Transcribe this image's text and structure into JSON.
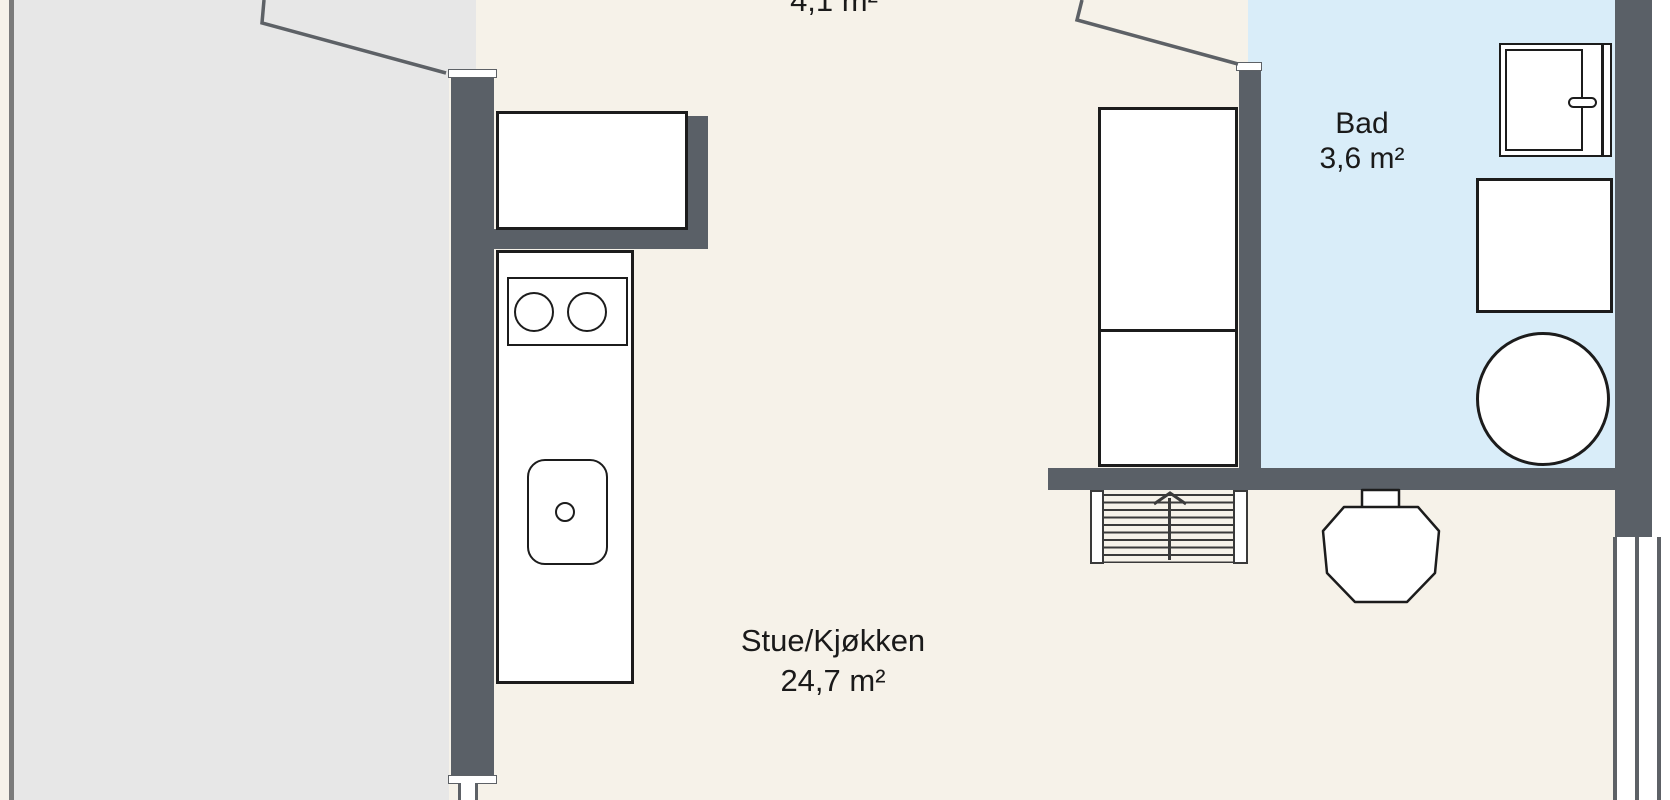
{
  "plan_title": "Floor plan",
  "rooms": {
    "top_partial": {
      "area": "4,1 m²"
    },
    "bathroom": {
      "name": "Bad",
      "area": "3,6 m²"
    },
    "living_kitchen": {
      "name": "Stue/Kjøkken",
      "area": "24,7 m²"
    }
  },
  "colors": {
    "wall": "#5a6067",
    "floor": "#f6f2e9",
    "terrace": "#e7e7e7",
    "bathroom": "#d9edf9",
    "outline": "#1c1c1c",
    "line": "#5d6166",
    "railing": "#7b7b7b",
    "text": "#1a1a1a",
    "white": "#ffffff"
  }
}
